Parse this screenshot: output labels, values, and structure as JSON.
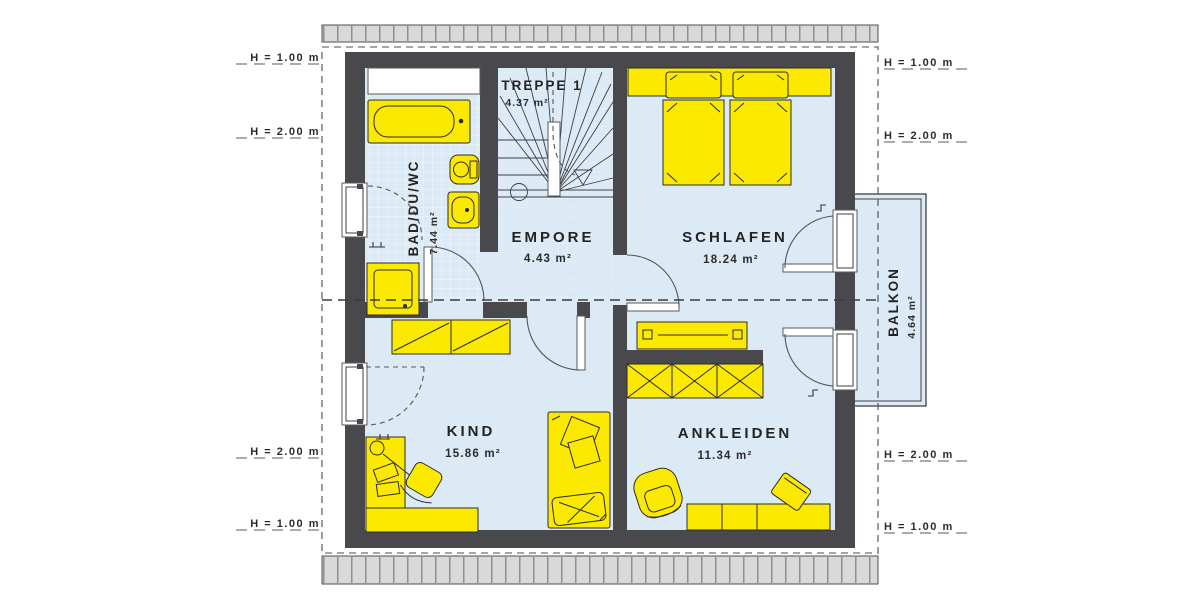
{
  "rooms": {
    "treppe": {
      "name": "TREPPE 1",
      "area": "4.37 m²"
    },
    "bad": {
      "name": "BAD/DU/WC",
      "area": "7.44 m²"
    },
    "empore": {
      "name": "EMPORE",
      "area": "4.43 m²"
    },
    "schlafen": {
      "name": "SCHLAFEN",
      "area": "18.24 m²"
    },
    "kind": {
      "name": "KIND",
      "area": "15.86 m²"
    },
    "ankleiden": {
      "name": "ANKLEIDEN",
      "area": "11.34 m²"
    },
    "balkon": {
      "name": "BALKON",
      "area": "4.64 m²"
    }
  },
  "height_markers": {
    "left": [
      "H = 1.00 m",
      "H = 2.00 m",
      "H = 2.00 m",
      "H = 1.00 m"
    ],
    "right": [
      "H = 1.00 m",
      "H = 2.00 m",
      "H = 2.00 m",
      "H = 1.00 m"
    ]
  },
  "colors": {
    "wall": "#48484d",
    "floor": "#dceaf6",
    "furniture_fill": "#fbe900",
    "outline": "#2c2c2c",
    "roof_hatch": "#d9d9d9"
  }
}
